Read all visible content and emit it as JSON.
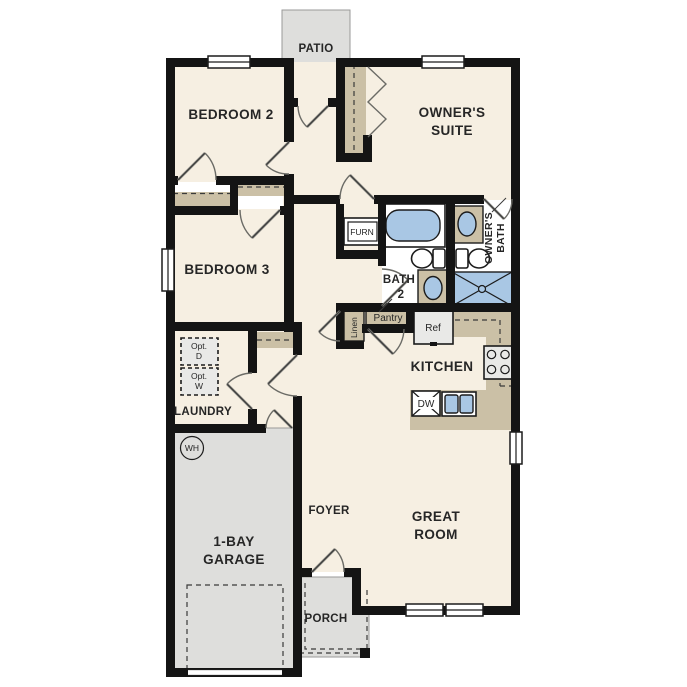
{
  "colors": {
    "floor": "#f6efe2",
    "outdoor": "#dededc",
    "casework": "#cbc0a6",
    "fixture_blue": "#a9c7e4",
    "appliance_gray": "#e9e9e7",
    "wall": "#141414",
    "text": "#262626"
  },
  "labels": {
    "patio": "PATIO",
    "bedroom2": "BEDROOM 2",
    "owners_suite_1": "OWNER'S",
    "owners_suite_2": "SUITE",
    "bedroom3": "BEDROOM 3",
    "furnace": "FURN",
    "owners_bath_1": "OWNER'S",
    "owners_bath_2": "BATH",
    "bath2_1": "BATH",
    "bath2_2": "2",
    "linen": "Linen",
    "pantry": "Pantry",
    "refrigerator": "Ref",
    "kitchen": "KITCHEN",
    "dishwasher": "DW",
    "laundry": "LAUNDRY",
    "opt_dryer_1": "Opt.",
    "opt_dryer_2": "D",
    "opt_washer_1": "Opt.",
    "opt_washer_2": "W",
    "water_heater": "WH",
    "garage_1": "1-BAY",
    "garage_2": "GARAGE",
    "foyer": "FOYER",
    "great_room_1": "GREAT",
    "great_room_2": "ROOM",
    "porch": "PORCH"
  }
}
